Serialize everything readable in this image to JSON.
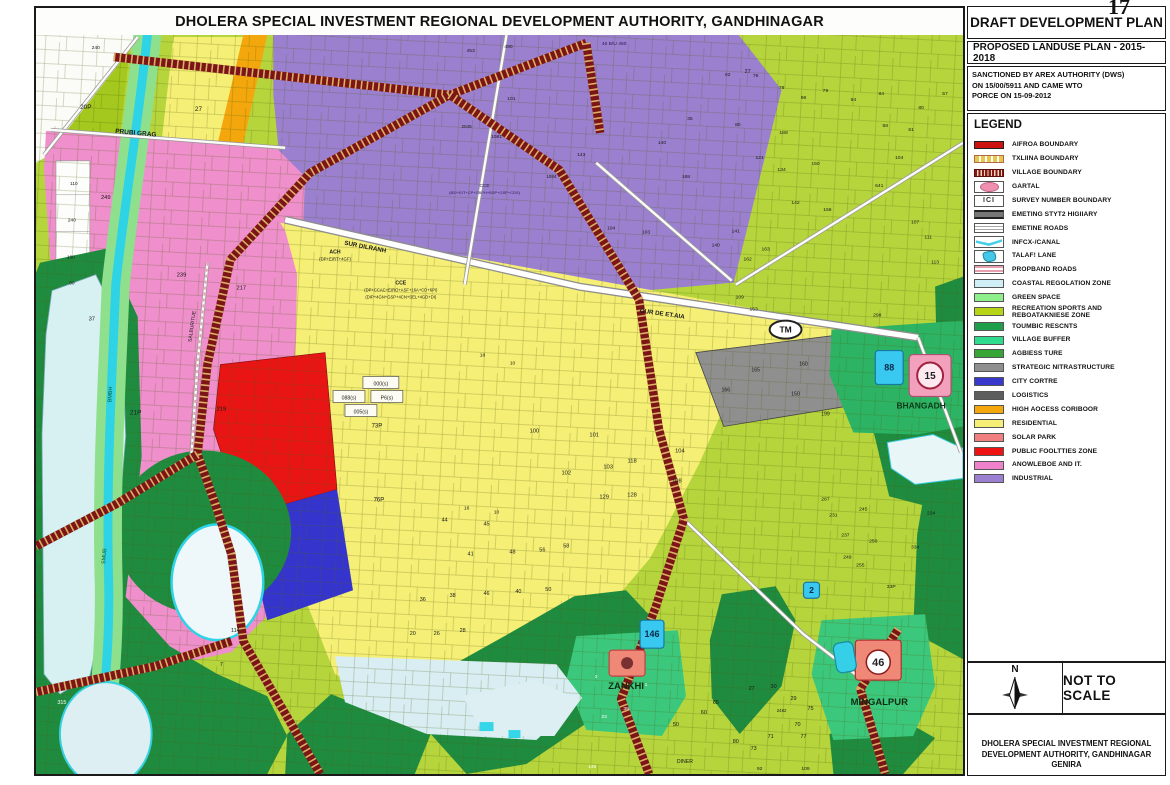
{
  "page_number": "17",
  "map": {
    "title": "DHOLERA SPECIAL INVESTMENT REGIONAL DEVELOPMENT AUTHORITY, GANDHINAGAR",
    "labels": [
      {
        "t": "PRUBI GRAG",
        "x": 100,
        "y": 100,
        "s": 6.5,
        "b": 1,
        "r": 5
      },
      {
        "t": "SUR DILRANH",
        "x": 330,
        "y": 214,
        "s": 6.2,
        "b": 1,
        "r": 11
      },
      {
        "t": "OUR DE ET.AIA",
        "x": 628,
        "y": 281,
        "s": 6.2,
        "b": 1,
        "r": 8
      },
      {
        "t": "SALBURITUE",
        "x": 158,
        "y": 292,
        "s": 5,
        "r": -82
      },
      {
        "t": "BMBH",
        "x": 76,
        "y": 360,
        "s": 5.5,
        "r": -87,
        "c": "#0a5a2a"
      },
      {
        "t": "SMUB",
        "x": 70,
        "y": 522,
        "s": 5.5,
        "r": -85,
        "c": "#0a5a2a"
      },
      {
        "t": "ZANKHI",
        "x": 592,
        "y": 655,
        "s": 9.5,
        "b": 1,
        "c": "#102a10"
      },
      {
        "t": "MINGALPUR",
        "x": 846,
        "y": 671,
        "s": 9.5,
        "b": 1,
        "c": "#102a10"
      },
      {
        "t": "BHANGADH",
        "x": 888,
        "y": 374,
        "s": 8.5,
        "b": 1,
        "c": "#0a3a1a"
      },
      {
        "t": "DINER",
        "x": 651,
        "y": 729,
        "s": 5.2
      },
      {
        "t": "ACH",
        "x": 300,
        "y": 219,
        "s": 5.2,
        "b": 1
      },
      {
        "t": "(DP+EIRT+4GF)",
        "x": 300,
        "y": 226,
        "s": 4.3
      },
      {
        "t": "CCE",
        "x": 366,
        "y": 250,
        "s": 5.2,
        "b": 1
      },
      {
        "t": "(DP+CCAC+EIRO+ASF+16A+CD+6PI)",
        "x": 366,
        "y": 257,
        "s": 4.2
      },
      {
        "t": "(DIP+4GN+GSP+4CN+SEL+4GD+DI)",
        "x": 366,
        "y": 264,
        "s": 4.2
      },
      {
        "t": "CCE",
        "x": 450,
        "y": 152,
        "s": 4.8,
        "c": "#2a1a55"
      },
      {
        "t": "(BS/+EIT+CP+GBPH+BSP+GSP+CDS)",
        "x": 450,
        "y": 159,
        "s": 4,
        "c": "#2a1a55"
      },
      {
        "t": "46 B/U 460",
        "x": 580,
        "y": 10,
        "s": 5,
        "c": "#2a1a55"
      },
      {
        "t": "240",
        "x": 60,
        "y": 14,
        "s": 5
      },
      {
        "t": "20P",
        "x": 50,
        "y": 74,
        "s": 6.5
      },
      {
        "t": "27",
        "x": 163,
        "y": 76,
        "s": 6.5
      },
      {
        "t": "110",
        "x": 38,
        "y": 150,
        "s": 4.8
      },
      {
        "t": "240",
        "x": 36,
        "y": 187,
        "s": 4.8
      },
      {
        "t": "160",
        "x": 35,
        "y": 224,
        "s": 4.8
      },
      {
        "t": "00",
        "x": 36,
        "y": 250,
        "s": 4.8
      },
      {
        "t": "37",
        "x": 56,
        "y": 286,
        "s": 5.8
      },
      {
        "t": "249",
        "x": 70,
        "y": 164,
        "s": 5.8
      },
      {
        "t": "239",
        "x": 146,
        "y": 242,
        "s": 5.8
      },
      {
        "t": "217",
        "x": 206,
        "y": 255,
        "s": 5.8
      },
      {
        "t": "219",
        "x": 186,
        "y": 376,
        "s": 5.8
      },
      {
        "t": "21P",
        "x": 100,
        "y": 380,
        "s": 6.5
      },
      {
        "t": "114",
        "x": 200,
        "y": 598,
        "s": 5.5
      },
      {
        "t": "7",
        "x": 186,
        "y": 632,
        "s": 5.5
      },
      {
        "t": "315",
        "x": 26,
        "y": 670,
        "s": 5.5,
        "c": "#ffffff"
      },
      {
        "t": "145",
        "x": 558,
        "y": 734,
        "s": 4.8,
        "c": "#ffffff"
      },
      {
        "t": "453",
        "x": 436,
        "y": 17,
        "s": 5
      },
      {
        "t": "490",
        "x": 474,
        "y": 13,
        "s": 5
      },
      {
        "t": "101",
        "x": 477,
        "y": 65,
        "s": 5
      },
      {
        "t": "1081",
        "x": 462,
        "y": 103,
        "s": 5
      },
      {
        "t": "2045",
        "x": 432,
        "y": 93,
        "s": 4.6
      },
      {
        "t": "140",
        "x": 628,
        "y": 109,
        "s": 5
      },
      {
        "t": "35",
        "x": 656,
        "y": 85,
        "s": 5
      },
      {
        "t": "62",
        "x": 694,
        "y": 41,
        "s": 5
      },
      {
        "t": "80",
        "x": 704,
        "y": 91,
        "s": 5
      },
      {
        "t": "168",
        "x": 652,
        "y": 143,
        "s": 5
      },
      {
        "t": "103",
        "x": 612,
        "y": 199,
        "s": 5
      },
      {
        "t": "104",
        "x": 577,
        "y": 195,
        "s": 5
      },
      {
        "t": "1084",
        "x": 517,
        "y": 143,
        "s": 4.6
      },
      {
        "t": "143",
        "x": 547,
        "y": 121,
        "s": 5
      },
      {
        "t": "27",
        "x": 714,
        "y": 38,
        "s": 5.5
      },
      {
        "t": "18",
        "x": 448,
        "y": 322,
        "s": 5
      },
      {
        "t": "10",
        "x": 478,
        "y": 330,
        "s": 5
      },
      {
        "t": "100",
        "x": 500,
        "y": 398,
        "s": 5.8
      },
      {
        "t": "101",
        "x": 560,
        "y": 402,
        "s": 5.8
      },
      {
        "t": "102",
        "x": 532,
        "y": 440,
        "s": 5.8
      },
      {
        "t": "103",
        "x": 574,
        "y": 434,
        "s": 5.8
      },
      {
        "t": "118",
        "x": 598,
        "y": 428,
        "s": 5.8
      },
      {
        "t": "128",
        "x": 598,
        "y": 462,
        "s": 5.8
      },
      {
        "t": "129",
        "x": 570,
        "y": 464,
        "s": 5.8
      },
      {
        "t": "104",
        "x": 646,
        "y": 418,
        "s": 5.8
      },
      {
        "t": "108",
        "x": 643,
        "y": 448,
        "s": 5.8
      },
      {
        "t": "73P",
        "x": 342,
        "y": 393,
        "s": 6
      },
      {
        "t": "76P",
        "x": 344,
        "y": 467,
        "s": 6
      },
      {
        "t": "44",
        "x": 410,
        "y": 487,
        "s": 5.5
      },
      {
        "t": "45",
        "x": 452,
        "y": 491,
        "s": 5.5
      },
      {
        "t": "41",
        "x": 436,
        "y": 521,
        "s": 5.5
      },
      {
        "t": "48",
        "x": 478,
        "y": 519,
        "s": 5.5
      },
      {
        "t": "56",
        "x": 508,
        "y": 517,
        "s": 5.5
      },
      {
        "t": "58",
        "x": 532,
        "y": 513,
        "s": 5.5
      },
      {
        "t": "16",
        "x": 432,
        "y": 475,
        "s": 5
      },
      {
        "t": "10",
        "x": 462,
        "y": 479,
        "s": 5
      },
      {
        "t": "36",
        "x": 388,
        "y": 567,
        "s": 5.5
      },
      {
        "t": "38",
        "x": 418,
        "y": 563,
        "s": 5.5
      },
      {
        "t": "46",
        "x": 452,
        "y": 561,
        "s": 5.5
      },
      {
        "t": "40",
        "x": 484,
        "y": 559,
        "s": 5.5
      },
      {
        "t": "50",
        "x": 514,
        "y": 557,
        "s": 5.5
      },
      {
        "t": "26",
        "x": 402,
        "y": 601,
        "s": 5.5
      },
      {
        "t": "28",
        "x": 428,
        "y": 598,
        "s": 5.5
      },
      {
        "t": "20",
        "x": 378,
        "y": 601,
        "s": 5.5
      },
      {
        "t": "165",
        "x": 722,
        "y": 337,
        "s": 5.2
      },
      {
        "t": "160",
        "x": 770,
        "y": 331,
        "s": 5.2
      },
      {
        "t": "150",
        "x": 762,
        "y": 361,
        "s": 5.2
      },
      {
        "t": "166",
        "x": 692,
        "y": 357,
        "s": 5.2
      },
      {
        "t": "199",
        "x": 792,
        "y": 381,
        "s": 5.2
      },
      {
        "t": "76",
        "x": 722,
        "y": 42,
        "s": 5
      },
      {
        "t": "78",
        "x": 748,
        "y": 54,
        "s": 5
      },
      {
        "t": "96",
        "x": 770,
        "y": 64,
        "s": 5
      },
      {
        "t": "79",
        "x": 792,
        "y": 57,
        "s": 5
      },
      {
        "t": "94",
        "x": 820,
        "y": 66,
        "s": 5
      },
      {
        "t": "84",
        "x": 848,
        "y": 60,
        "s": 5
      },
      {
        "t": "80",
        "x": 888,
        "y": 74,
        "s": 5
      },
      {
        "t": "58",
        "x": 852,
        "y": 92,
        "s": 5
      },
      {
        "t": "61",
        "x": 878,
        "y": 96,
        "s": 5
      },
      {
        "t": "57",
        "x": 912,
        "y": 60,
        "s": 5
      },
      {
        "t": "188",
        "x": 750,
        "y": 99,
        "s": 5
      },
      {
        "t": "121",
        "x": 726,
        "y": 124,
        "s": 5
      },
      {
        "t": "134",
        "x": 748,
        "y": 136,
        "s": 5
      },
      {
        "t": "150",
        "x": 782,
        "y": 130,
        "s": 5
      },
      {
        "t": "142",
        "x": 762,
        "y": 169,
        "s": 5
      },
      {
        "t": "166",
        "x": 794,
        "y": 176,
        "s": 5
      },
      {
        "t": "140",
        "x": 682,
        "y": 212,
        "s": 5
      },
      {
        "t": "141",
        "x": 702,
        "y": 198,
        "s": 5
      },
      {
        "t": "162",
        "x": 714,
        "y": 226,
        "s": 5
      },
      {
        "t": "163",
        "x": 732,
        "y": 216,
        "s": 5
      },
      {
        "t": "641",
        "x": 846,
        "y": 152,
        "s": 5
      },
      {
        "t": "298",
        "x": 844,
        "y": 282,
        "s": 5
      },
      {
        "t": "109",
        "x": 706,
        "y": 264,
        "s": 5
      },
      {
        "t": "153",
        "x": 720,
        "y": 276,
        "s": 5
      },
      {
        "t": "104",
        "x": 866,
        "y": 124,
        "s": 5
      },
      {
        "t": "107",
        "x": 882,
        "y": 189,
        "s": 5
      },
      {
        "t": "111",
        "x": 895,
        "y": 204,
        "s": 5
      },
      {
        "t": "113",
        "x": 902,
        "y": 229,
        "s": 5
      },
      {
        "t": "334",
        "x": 882,
        "y": 514,
        "s": 5
      },
      {
        "t": "255",
        "x": 827,
        "y": 532,
        "s": 5
      },
      {
        "t": "250",
        "x": 840,
        "y": 508,
        "s": 5
      },
      {
        "t": "237",
        "x": 812,
        "y": 502,
        "s": 5
      },
      {
        "t": "287",
        "x": 792,
        "y": 466,
        "s": 5
      },
      {
        "t": "245",
        "x": 830,
        "y": 476,
        "s": 5
      },
      {
        "t": "231",
        "x": 800,
        "y": 482,
        "s": 5
      },
      {
        "t": "249",
        "x": 814,
        "y": 524,
        "s": 5
      },
      {
        "t": "234",
        "x": 898,
        "y": 480,
        "s": 5
      },
      {
        "t": "33P",
        "x": 858,
        "y": 554,
        "s": 5
      },
      {
        "t": "23",
        "x": 570,
        "y": 684,
        "s": 5,
        "c": "#ffffff"
      },
      {
        "t": "39",
        "x": 592,
        "y": 676,
        "s": 5,
        "c": "#ffffff"
      },
      {
        "t": "1",
        "x": 612,
        "y": 652,
        "s": 5,
        "c": "#ffffff"
      },
      {
        "t": "2",
        "x": 562,
        "y": 644,
        "s": 5,
        "c": "#ffffff"
      },
      {
        "t": "50",
        "x": 642,
        "y": 692,
        "s": 5.5
      },
      {
        "t": "60",
        "x": 670,
        "y": 680,
        "s": 5.5
      },
      {
        "t": "65",
        "x": 682,
        "y": 670,
        "s": 5.5
      },
      {
        "t": "27",
        "x": 718,
        "y": 656,
        "s": 5.5
      },
      {
        "t": "30",
        "x": 740,
        "y": 654,
        "s": 5.5
      },
      {
        "t": "29",
        "x": 760,
        "y": 666,
        "s": 5.5
      },
      {
        "t": "75",
        "x": 777,
        "y": 676,
        "s": 5.5
      },
      {
        "t": "70",
        "x": 764,
        "y": 692,
        "s": 5.5
      },
      {
        "t": "77",
        "x": 770,
        "y": 704,
        "s": 5.5
      },
      {
        "t": "71",
        "x": 737,
        "y": 704,
        "s": 5.5
      },
      {
        "t": "73",
        "x": 720,
        "y": 716,
        "s": 5.5
      },
      {
        "t": "80",
        "x": 702,
        "y": 709,
        "s": 5.5
      },
      {
        "t": "2482",
        "x": 748,
        "y": 678,
        "s": 4.4
      },
      {
        "t": "92",
        "x": 726,
        "y": 736,
        "s": 5
      },
      {
        "t": "109",
        "x": 772,
        "y": 736,
        "s": 5
      },
      {
        "t": "000(s)",
        "x": 346,
        "y": 351,
        "s": 5.2
      },
      {
        "t": "088(s)",
        "x": 314,
        "y": 365,
        "s": 5.2
      },
      {
        "t": "P6(s)",
        "x": 352,
        "y": 365,
        "s": 5.2
      },
      {
        "t": "005(s)",
        "x": 326,
        "y": 379,
        "s": 5.2
      }
    ],
    "badges": [
      {
        "type": "oval",
        "text": "TM",
        "x": 752,
        "y": 295
      },
      {
        "type": "village-marker",
        "text": "46",
        "x": 822,
        "y": 606,
        "w": 46,
        "h": 40
      },
      {
        "type": "circle-marker",
        "text": "15",
        "x": 876,
        "y": 320,
        "w": 42,
        "h": 42
      },
      {
        "type": "cyan-rect",
        "text": "88",
        "x": 842,
        "y": 316,
        "w": 28,
        "h": 34
      },
      {
        "type": "cyan-rect",
        "text": "2",
        "x": 770,
        "y": 548,
        "w": 16,
        "h": 16
      },
      {
        "type": "cyan-rect",
        "text": "146",
        "x": 606,
        "y": 586,
        "w": 24,
        "h": 28
      },
      {
        "type": "zankhi-marker",
        "text": "",
        "x": 575,
        "y": 616,
        "w": 36,
        "h": 26
      },
      {
        "type": "cyan-blob",
        "text": "",
        "x": 799,
        "y": 610,
        "w": 20,
        "h": 30
      }
    ]
  },
  "panel": {
    "title": "DRAFT DEVELOPMENT PLAN",
    "subtitle": "PROPOSED LANDUSE PLAN - 2015-2018",
    "sanction_lines": [
      "SANCTIONED BY AREX AUTHORITY (DWS)",
      "ON 15/00/5911 AND CAME WTO",
      "PORCE ON 15-09-2012"
    ],
    "legend": {
      "header": "LEGEND",
      "items": [
        {
          "label": "AIFROA BOUNDARY",
          "swatch": "line-solid",
          "color": "#cc1111"
        },
        {
          "label": "TXLIINA BOUNDARY",
          "swatch": "line-dashed",
          "color": "#e8c84a"
        },
        {
          "label": "VILLAGE BOUNDARY",
          "swatch": "line-hatch",
          "color": "#8a1a1a"
        },
        {
          "label": "GARTAL",
          "swatch": "ellipse",
          "color": "#f090b0"
        },
        {
          "label": "SURVEY NUMBER BOUNDARY",
          "swatch": "survey",
          "color": "#333333"
        },
        {
          "label": "EMETING STYT2 HIGIIARY",
          "swatch": "line-thick",
          "color": "#777777"
        },
        {
          "label": "EMETINE ROADS",
          "swatch": "line-thin",
          "color": "#a8a8a8"
        },
        {
          "label": "INFCX-/CANAL",
          "swatch": "canal",
          "color": "#45d0e8"
        },
        {
          "label": "TALAF! LANE",
          "swatch": "pond",
          "color": "#45c8e8"
        },
        {
          "label": "PROPBAND ROADS",
          "swatch": "line-stripes",
          "color": "#e8a0b0"
        },
        {
          "label": "COASTAL REGOLATION ZONE",
          "swatch": "fill",
          "color": "#cfeef5"
        },
        {
          "label": "GREEN SPACE",
          "swatch": "fill",
          "color": "#8df08d"
        },
        {
          "label": "RECREATION SPORTS AND REBOATAKNIESE ZONE",
          "swatch": "fill",
          "color": "#b8d416"
        },
        {
          "label": "TOUMBIC RESCNTS",
          "swatch": "fill",
          "color": "#1e9e4a"
        },
        {
          "label": "VILLAGE BUFFER",
          "swatch": "fill",
          "color": "#2fdc8e"
        },
        {
          "label": "AGBIESS TURE",
          "swatch": "fill",
          "color": "#35a535"
        },
        {
          "label": "STRATEGIC NITRASTRUCTURE",
          "swatch": "fill",
          "color": "#8f8f8f"
        },
        {
          "label": "CITY CORTRE",
          "swatch": "fill",
          "color": "#3838cc"
        },
        {
          "label": "LOGISTICS",
          "swatch": "fill",
          "color": "#5d5d5d"
        },
        {
          "label": "HIGH AOCESS CORIBOOR",
          "swatch": "fill",
          "color": "#f3a70c"
        },
        {
          "label": "RESIDENTIAL",
          "swatch": "fill",
          "color": "#f6ef75"
        },
        {
          "label": "SOLAR PARK",
          "swatch": "fill",
          "color": "#f08080"
        },
        {
          "label": "PUBLIC FOOLTTIES ZONE",
          "swatch": "fill",
          "color": "#ee1212"
        },
        {
          "label": "ANOWLEBOE AND IT.",
          "swatch": "fill",
          "color": "#ef82cb"
        },
        {
          "label": "INDUSTRIAL",
          "swatch": "fill",
          "color": "#9b7fd0"
        }
      ]
    },
    "north_label": "N",
    "scale_note": "NOT TO SCALE",
    "credit_lines": [
      "DHOLERA SPECIAL INVESTMENT REGIONAL",
      "DEVELOPMENT  AUTHORITY, GANDHINAGAR",
      "GENIRA"
    ]
  },
  "colors": {
    "residential": "#f6ef75",
    "industrial": "#9b7fd0",
    "recreation": "#b6d53c",
    "tourism_dark_green": "#1f8b3f",
    "village_buffer": "#3cc87c",
    "knowledge_it_pink": "#ef8fcb",
    "public_facilities_red": "#e91414",
    "city_centre_blue": "#3535cd",
    "high_access_orange": "#f3a70c",
    "strategic_gray": "#8f8f8f",
    "canal_cyan": "#2ed3e6",
    "coastal": "#d8eef2",
    "village_boundary": "#7c1616",
    "boundary_tick": "#dcaf66"
  }
}
